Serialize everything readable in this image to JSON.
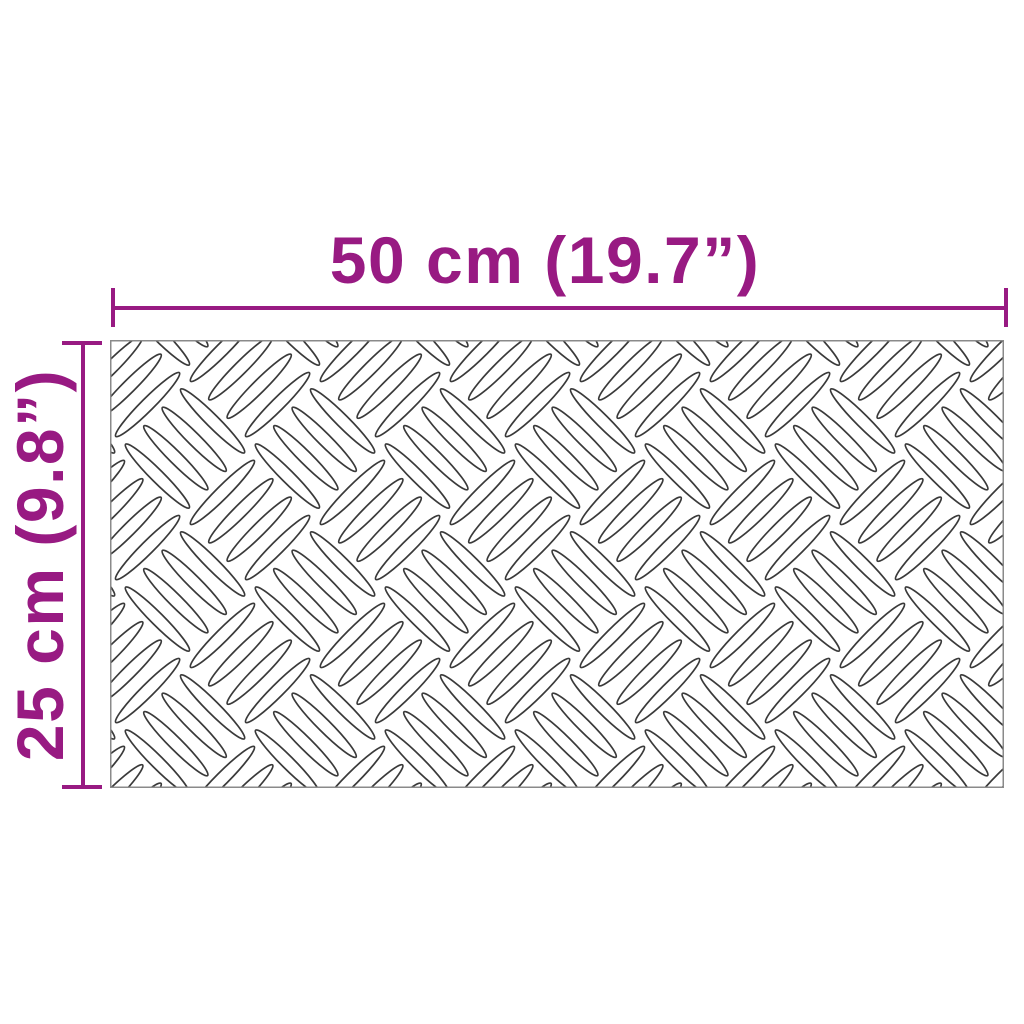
{
  "diagram": {
    "type": "product-dimension-diagram",
    "subject": "checker-plate-sheet",
    "dimensions": {
      "width_label": "50 cm (19.7”)",
      "height_label": "25 cm (9.8”)"
    },
    "pattern_name": "aluminium-checker-plate-tread"
  },
  "theme": {
    "accent": "#981a82",
    "pattern-stroke": "#3a3a3a",
    "plate-border": "#8a8a8a",
    "background": "#ffffff"
  }
}
